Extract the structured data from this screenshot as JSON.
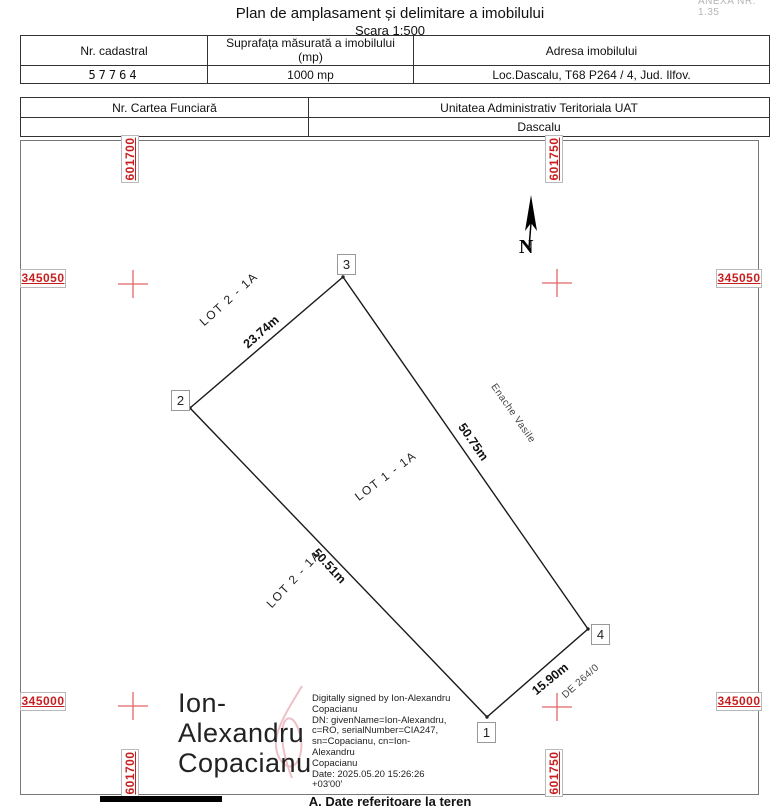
{
  "page": {
    "anexa": "ANEXA NR. 1.35",
    "title": "Plan de amplasament și delimitare a imobilului",
    "subtitle": "Scara 1:500",
    "bottom_section_heading": "A. Date referitoare la teren"
  },
  "table1": {
    "headers": {
      "cadastral": "Nr. cadastral",
      "area": "Suprafața măsurată a imobilului\n(mp)",
      "address": "Adresa imobilului"
    },
    "values": {
      "cadastral": "57764",
      "area": "1000 mp",
      "address": "Loc.Dascalu, T68  P264 / 4, Jud. Ilfov."
    }
  },
  "table2": {
    "headers": {
      "carte_funciara": "Nr. Cartea Funciară",
      "uat": "Unitatea Administrativ Teritoriala UAT"
    },
    "values": {
      "carte_funciara": "",
      "uat": "Dascalu"
    }
  },
  "map": {
    "grid_labels": {
      "top_left": "601700",
      "top_right": "601750",
      "bottom_left": "601700",
      "bottom_right": "601750",
      "left_top": "345050",
      "right_top": "345050",
      "left_bottom": "345000",
      "right_bottom": "345000"
    },
    "north_label": "N",
    "vertices": [
      "1",
      "2",
      "3",
      "4"
    ],
    "dimensions": {
      "side_2_3": "23.74m",
      "side_3_4": "50.75m",
      "side_2_1": "50.51m",
      "side_1_4": "15.90m"
    },
    "parcels": {
      "lot2_upper": "LOT 2 - 1A",
      "lot1": "LOT 1 - 1A",
      "lot2_lower": "LOT 2 - 1A"
    },
    "neighbors": {
      "east": "Enache Vasile",
      "road": "DE 264/0"
    },
    "colors": {
      "grid_label_red": "#c71f1f",
      "cross_red": "#e06666"
    }
  },
  "signature": {
    "name": "Ion-\nAlexandru\nCopacianu",
    "details": "Digitally signed by Ion-Alexandru\nCopacianu\nDN: givenName=Ion-Alexandru,\nc=RO, serialNumber=CIA247,\nsn=Copacianu, cn=Ion-Alexandru\nCopacianu\nDate: 2025.05.20 15:26:26 +03'00'"
  }
}
